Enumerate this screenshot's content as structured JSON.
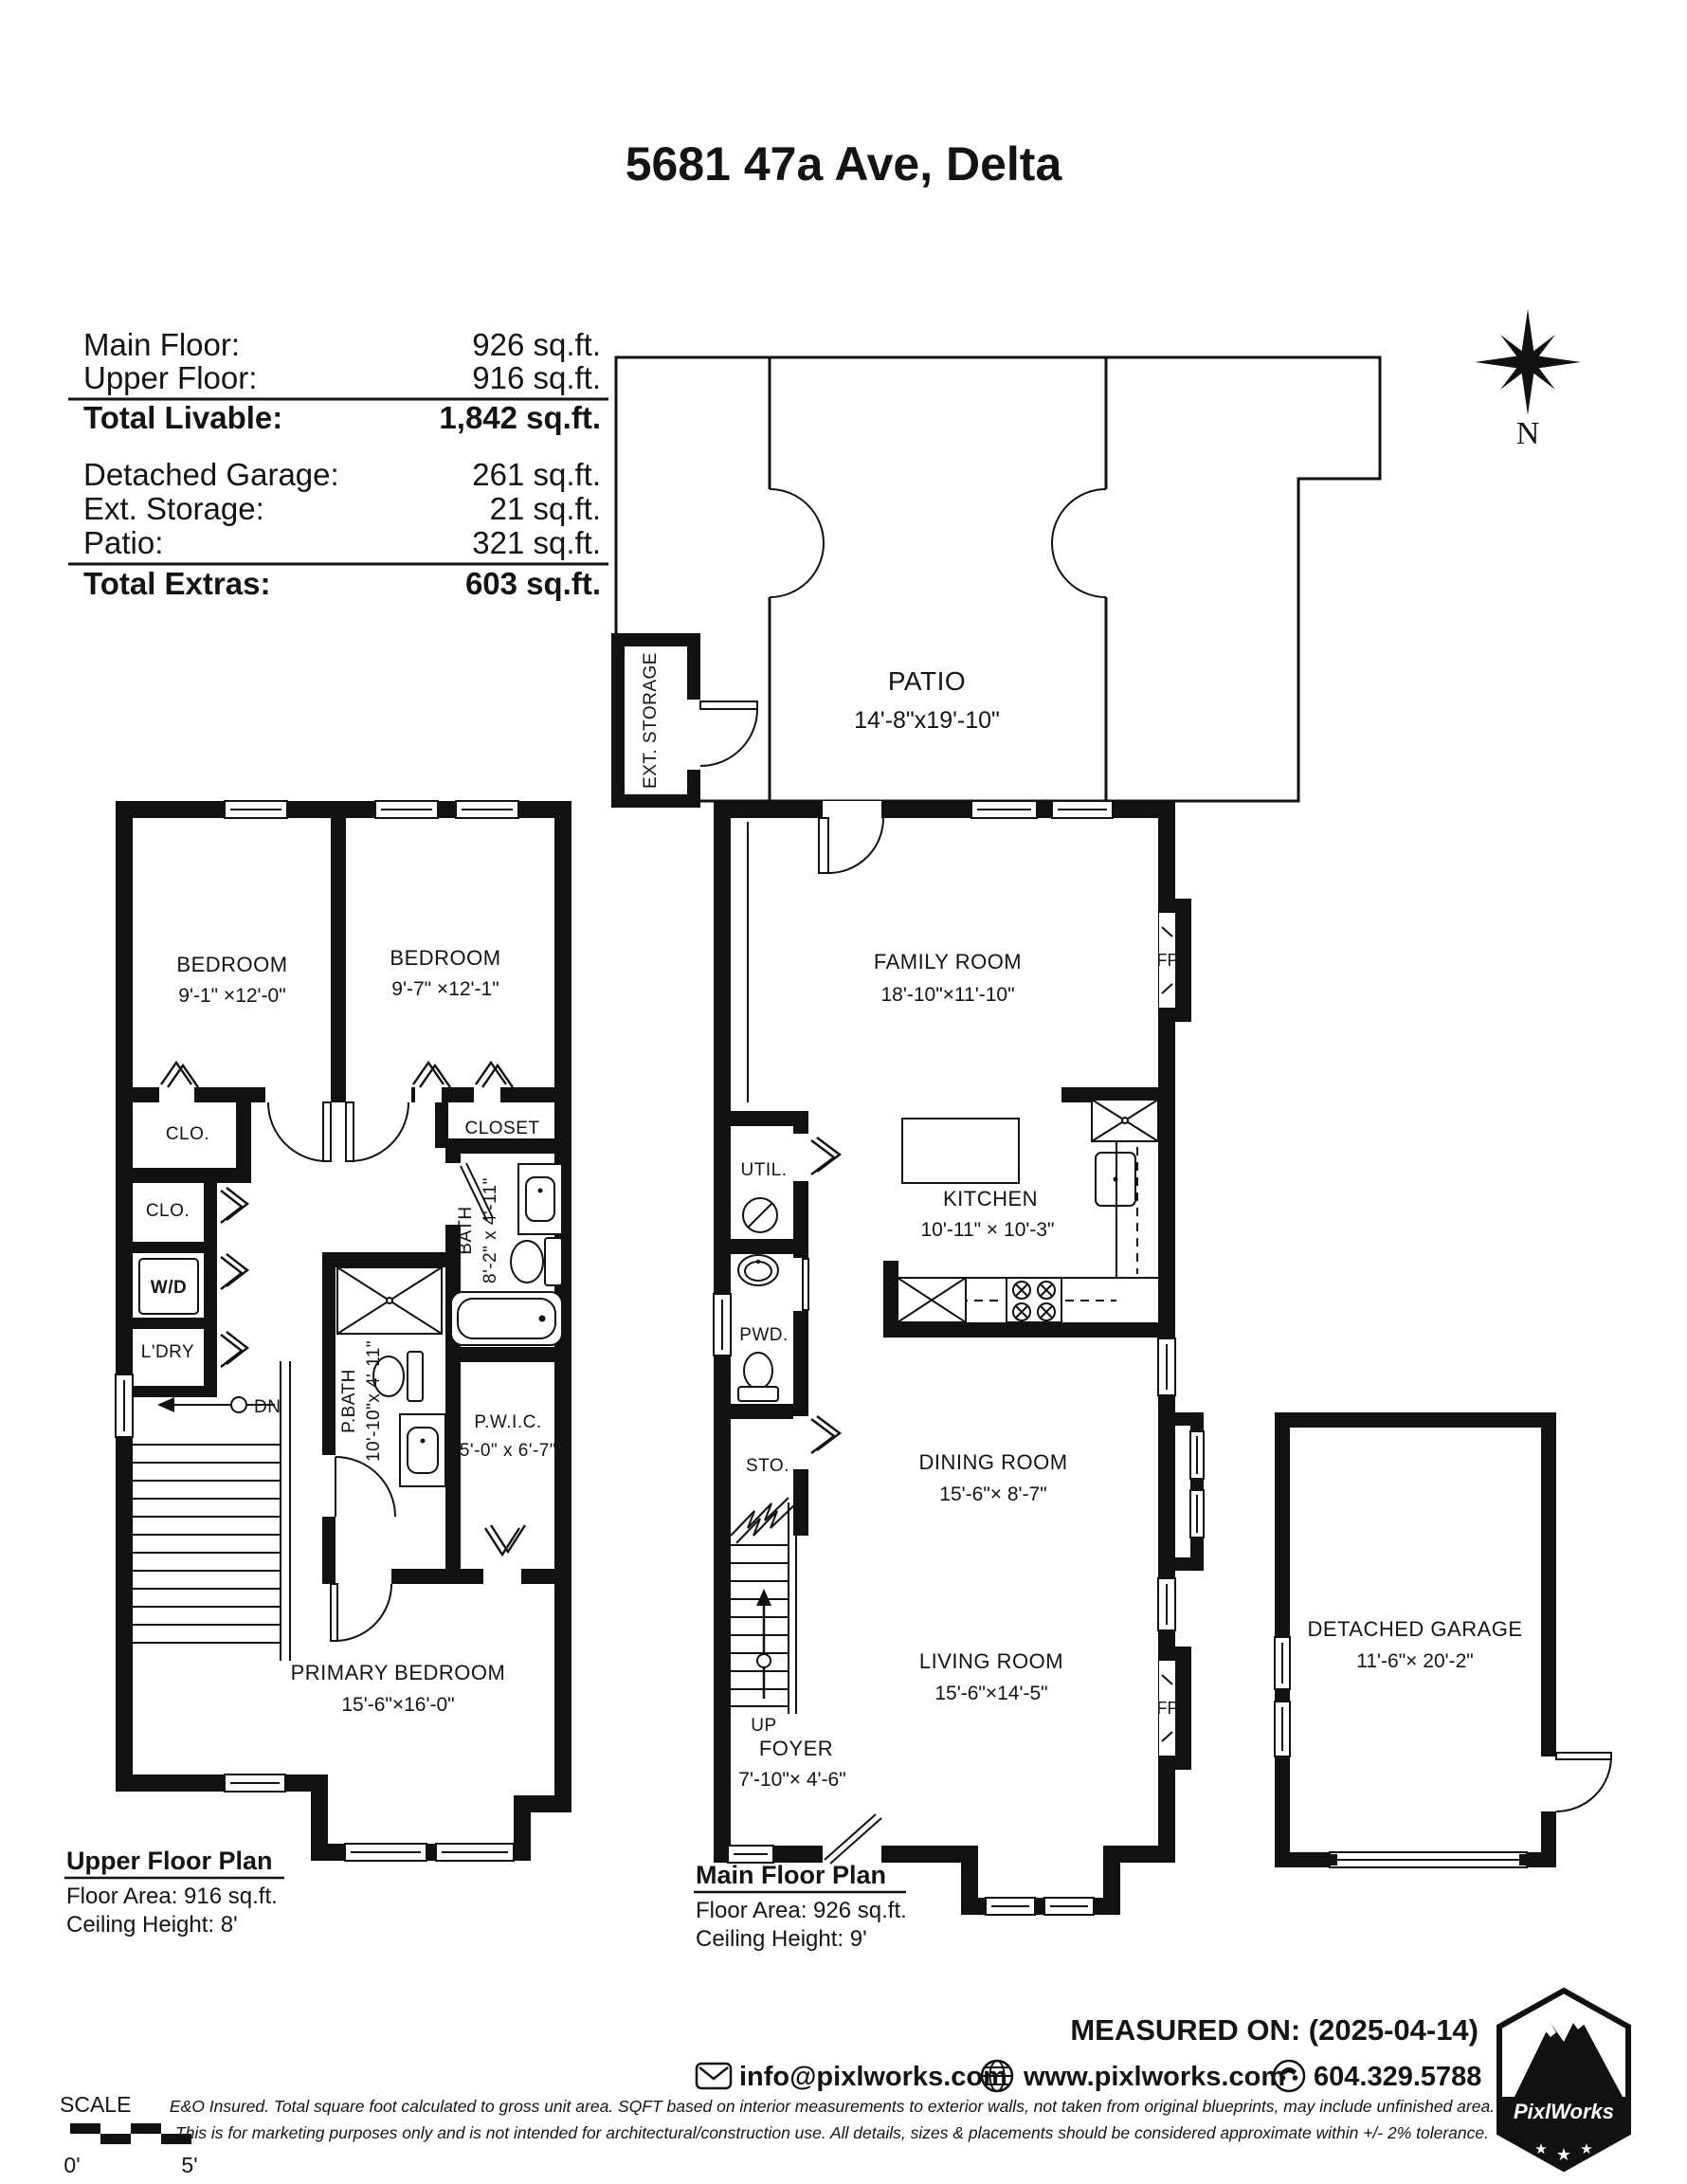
{
  "title": "5681 47a Ave, Delta",
  "area_summary": {
    "rows_livable": [
      {
        "label": "Main Floor:",
        "value": "926 sq.ft."
      },
      {
        "label": "Upper Floor:",
        "value": "916 sq.ft."
      }
    ],
    "total_livable": {
      "label": "Total Livable:",
      "value": "1,842 sq.ft."
    },
    "rows_extras": [
      {
        "label": "Detached Garage:",
        "value": "261 sq.ft."
      },
      {
        "label": "Ext. Storage:",
        "value": "21 sq.ft."
      },
      {
        "label": "Patio:",
        "value": "321 sq.ft."
      }
    ],
    "total_extras": {
      "label": "Total Extras:",
      "value": "603 sq.ft."
    }
  },
  "compass": {
    "north": "N"
  },
  "rooms": {
    "patio": {
      "name": "PATIO",
      "dims": "14'-8\"x19'-10\""
    },
    "ext_storage": {
      "name": "EXT. STORAGE"
    },
    "family_room": {
      "name": "FAMILY ROOM",
      "dims": "18'-10\"×11'-10\""
    },
    "util": {
      "name": "UTIL."
    },
    "pwd": {
      "name": "PWD."
    },
    "sto": {
      "name": "STO."
    },
    "kitchen": {
      "name": "KITCHEN",
      "dims": "10'-11\" × 10'-3\""
    },
    "dining_room": {
      "name": "DINING ROOM",
      "dims": "15'-6\"× 8'-7\""
    },
    "living_room": {
      "name": "LIVING ROOM",
      "dims": "15'-6\"×14'-5\""
    },
    "foyer": {
      "name": "FOYER",
      "dims": "7'-10\"× 4'-6\""
    },
    "fireplace": {
      "name": "FP"
    },
    "stairs_up": {
      "name": "UP"
    },
    "stairs_dn": {
      "name": "DN"
    },
    "bedroom_1": {
      "name": "BEDROOM",
      "dims": "9'-1\" ×12'-0\""
    },
    "bedroom_2": {
      "name": "BEDROOM",
      "dims": "9'-7\" ×12'-1\""
    },
    "clo_1": {
      "name": "CLO."
    },
    "clo_2": {
      "name": "CLO."
    },
    "closet": {
      "name": "CLOSET"
    },
    "wd": {
      "name": "W/D"
    },
    "laundry": {
      "name": "L'DRY"
    },
    "bath": {
      "name": "BATH",
      "dims": "8'-2\" x 4'-11\""
    },
    "primary_bath": {
      "name": "P.BATH",
      "dims": "10'-10\"x 4'-11\""
    },
    "pwic": {
      "name": "P.W.I.C.",
      "dims": "5'-0\" x 6'-7\""
    },
    "primary_bedroom": {
      "name": "PRIMARY BEDROOM",
      "dims": "15'-6\"×16'-0\""
    },
    "garage": {
      "name": "DETACHED GARAGE",
      "dims": "11'-6\"× 20'-2\""
    }
  },
  "plan_labels": {
    "upper": {
      "title": "Upper Floor Plan",
      "area": "Floor Area: 916 sq.ft.",
      "ceiling": "Ceiling Height: 8'"
    },
    "main": {
      "title": "Main Floor Plan",
      "area": "Floor Area: 926 sq.ft.",
      "ceiling": "Ceiling Height: 9'"
    }
  },
  "footer": {
    "measured_on": "MEASURED ON: (2025-04-14)",
    "email": "info@pixlworks.com",
    "website": "www.pixlworks.com",
    "phone": "604.329.5788",
    "disclaimer1": "E&O Insured.  Total square foot calculated to gross unit area. SQFT based on interior measurements to exterior walls, not taken from original blueprints, may include unfinished area.",
    "disclaimer2": "This is for marketing purposes only and is not intended for architectural/construction use.  All details, sizes & placements should be considered approximate within +/- 2%  tolerance.",
    "scale": {
      "label": "SCALE",
      "start": "0'",
      "end": "5'"
    },
    "logo_text": "PixlWorks"
  }
}
